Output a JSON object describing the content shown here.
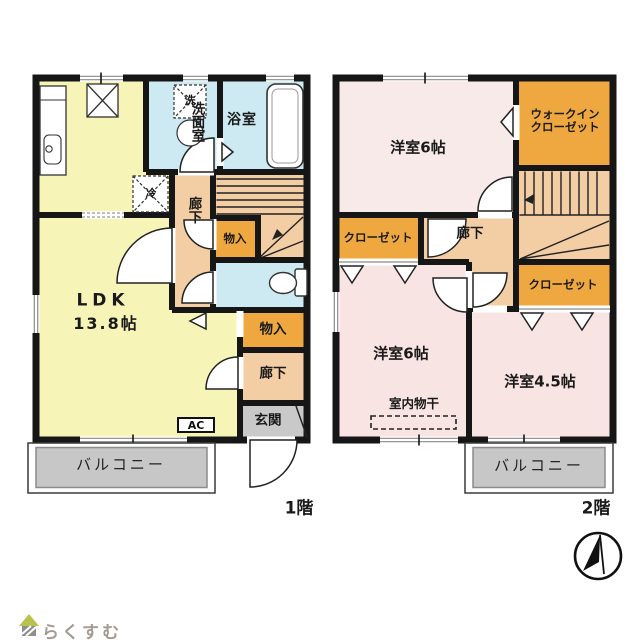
{
  "meta": {
    "document_type": "floor-plan",
    "background": "#ffffff"
  },
  "colors": {
    "wall": "#161616",
    "ldk_fill": "#f7f4b8",
    "wet_area_fill": "#cdeaf2",
    "hallway_fill": "#f3cda4",
    "closet_fill": "#eea83f",
    "bedroom_nw_fill": "#f9eaea",
    "bedroom_fill": "#f9e4e4",
    "balcony_fill": "#c7c7c7",
    "entrance_fill": "#c9c9c9",
    "logo_text": "#a29b94",
    "logo_roof": "#b9c24e"
  },
  "floor1": {
    "floor_label": "1階",
    "ldk_name": "LDK",
    "ldk_size": "13.8帖",
    "washroom": "洗面室",
    "bathroom": "浴室",
    "hallway_center": "廊下",
    "hallway_south": "廊下",
    "storage_stairs": "物入",
    "storage_south": "物入",
    "entrance": "玄関",
    "ac_unit": "AC",
    "balcony": "バルコニー",
    "washer_mark": "洗",
    "fridge_mark": "冷"
  },
  "floor2": {
    "floor_label": "2階",
    "bedroom_nw": "洋室6帖",
    "bedroom_sw": "洋室6帖",
    "bedroom_se": "洋室4.5帖",
    "walk_in_closet_line1": "ウォークイン",
    "walk_in_closet_line2": "クローゼット",
    "closet_west": "クローゼット",
    "closet_east": "クローゼット",
    "hallway": "廊下",
    "indoor_drying": "室内物干",
    "balcony": "バルコニー"
  },
  "footer": {
    "logo_text": "らくすむ"
  }
}
